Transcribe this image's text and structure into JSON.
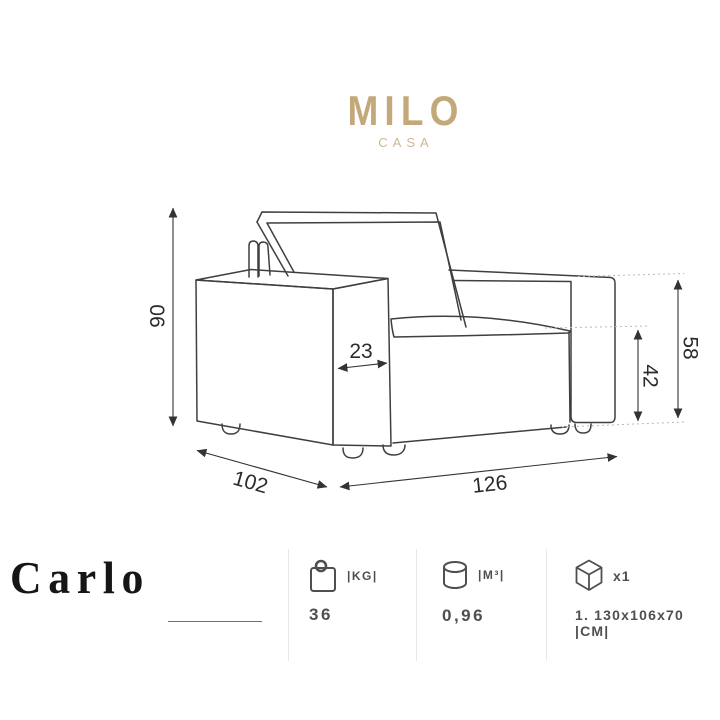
{
  "brand": {
    "name": "MILO",
    "subtitle": "CASA",
    "color": "#c3a87a"
  },
  "product": {
    "name": "Carlo"
  },
  "drawing": {
    "dimensions": {
      "overall_height": "90",
      "armrest_width": "23",
      "seat_height": "42",
      "armrest_height": "58",
      "depth": "102",
      "width": "126"
    }
  },
  "specs": {
    "weight": {
      "icon": "bag-icon",
      "unit": "|KG|",
      "value": "36"
    },
    "volume": {
      "icon": "cylinder-icon",
      "unit": "|M³|",
      "value": "0,96"
    },
    "package": {
      "icon": "box-icon",
      "count": "x1",
      "value": "1. 130x106x70 |CM|"
    }
  }
}
